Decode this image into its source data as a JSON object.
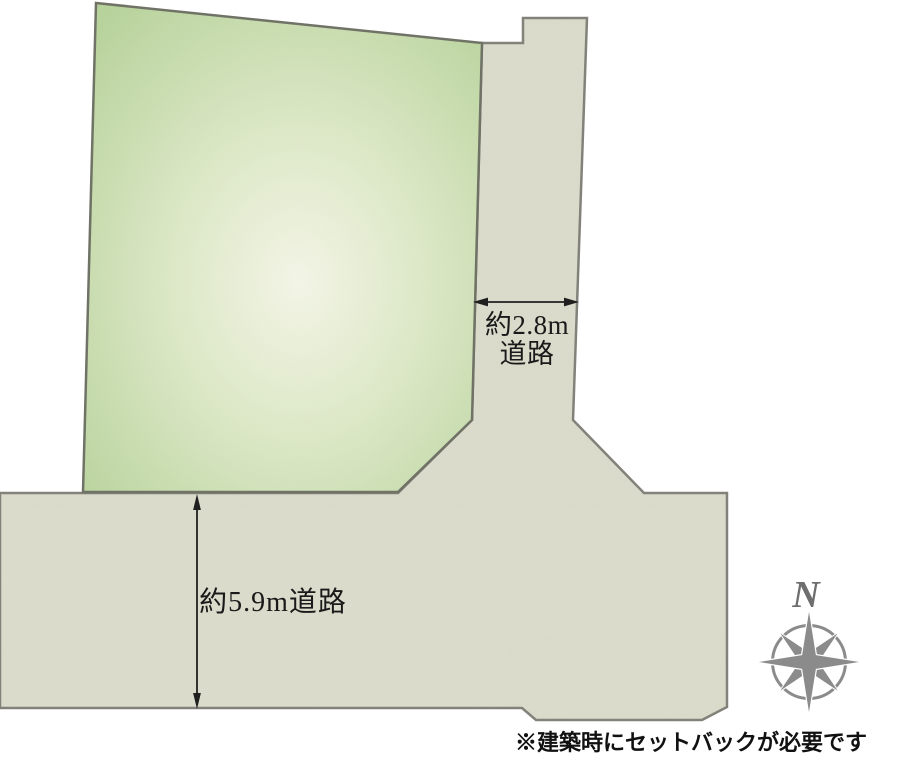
{
  "diagram": {
    "type": "land-plot-site-plan",
    "plot": {
      "fill_center": "#f5f6e8",
      "fill_mid": "#dde9c7",
      "fill_edge": "#b9d49d",
      "outline": "#6f7265"
    },
    "road": {
      "fill": "#dbdccc",
      "outline": "#82827a"
    },
    "dimensions": {
      "east_road": {
        "label_line1": "約2.8m",
        "label_line2": "道路"
      },
      "south_road": {
        "label": "約5.9m道路"
      },
      "arrow_color": "#1f1f1f"
    },
    "text_color": "#1a1a1a",
    "compass": {
      "north_label": "N",
      "rose_color": "#8b8b8b",
      "label_color": "#6e6e6e"
    },
    "note": {
      "text": "※建築時にセットバックが必要です",
      "color": "#111111"
    }
  }
}
